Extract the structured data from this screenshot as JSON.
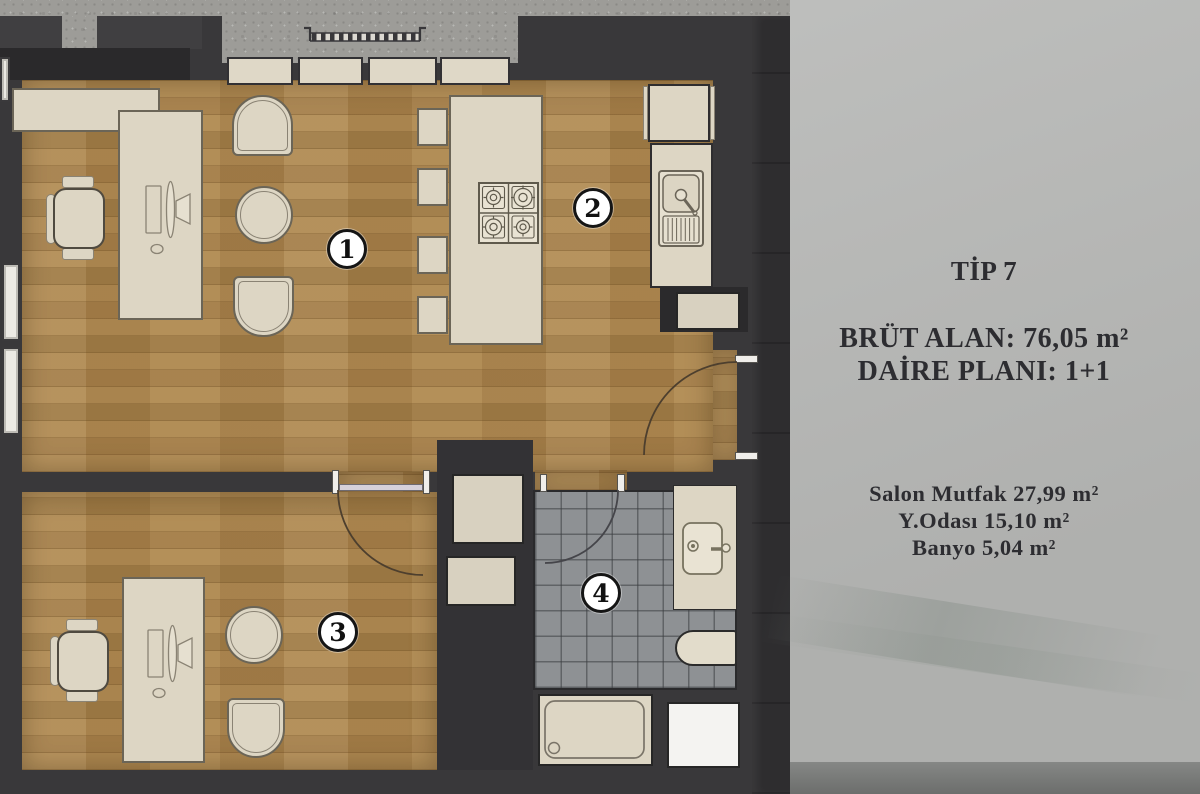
{
  "panel": {
    "title": "TİP 7",
    "info_lines": [
      "BRÜT ALAN: 76,05 m²",
      "DAİRE PLANI: 1+1"
    ],
    "area_lines": [
      "Salon Mutfak 27,99 m²",
      "Y.Odası 15,10 m²",
      "Banyo 5,04 m²"
    ]
  },
  "plan": {
    "badges": [
      {
        "label": "1"
      },
      {
        "label": "2"
      },
      {
        "label": "3"
      },
      {
        "label": "4"
      }
    ]
  },
  "colors": {
    "wall": "#39383a",
    "wall_dark": "#2a292b",
    "concrete": "#9d9c98",
    "wood": "#ac8750",
    "furniture_cream": "#ddd6c4",
    "tile_floor": "#8e9194",
    "panel_bg": "#b6b7b5",
    "panel_text": "#2d2d31",
    "panel_footer": "#7b7d7b",
    "badge_bg": "#ffffff",
    "badge_ring": "#151515"
  }
}
